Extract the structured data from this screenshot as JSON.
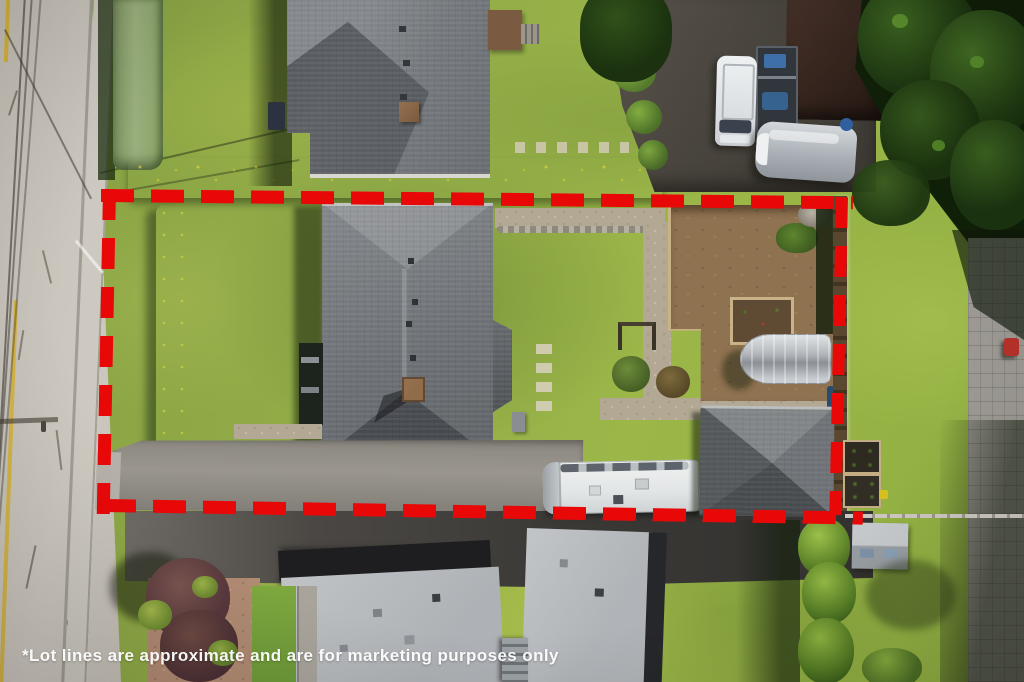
{
  "disclaimer": "*Lot lines are approximate and are for marketing purposes only",
  "annotation": {
    "type": "property-lot-boundary",
    "stroke_style": "dashed",
    "color": "#e90808"
  },
  "palette": {
    "lawn": "#93ad48",
    "bright_lawn": "#9cb63f",
    "road": "#c8c3bb",
    "dark_asphalt": "#3b3936",
    "roof_gray": "#6e7276",
    "flat_roof_gray": "#b9bcc0",
    "garden_soil": "#8f7250",
    "conifer_dark": "#16290e",
    "hedge_green": "#6f9a34",
    "boundary_red": "#e90808",
    "text_white": "#ffffff"
  }
}
